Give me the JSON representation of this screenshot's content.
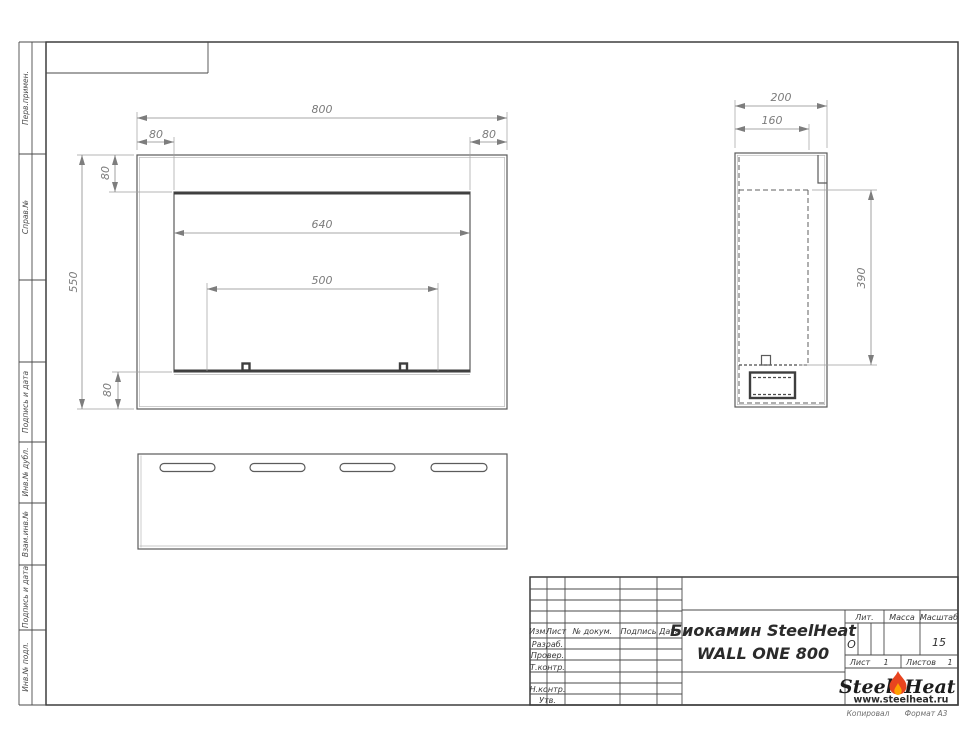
{
  "sheet": {
    "copied_note": "Копировал",
    "format_note": "Формат А3"
  },
  "sidebar": {
    "top_labels": [
      "Перв.примен.",
      "Справ.№"
    ],
    "bottom_labels": [
      "Подпись и дата",
      "Инв.№ дубл.",
      "Взам.инв.№",
      "Подпись и дата",
      "Инв.№ подл."
    ]
  },
  "title_block": {
    "header_cols": [
      "Изм.",
      "Лист",
      "№ докум.",
      "Подпись",
      "Дата"
    ],
    "row_labels": [
      "Разраб.",
      "Провер.",
      "Т.контр.",
      "Н.контр.",
      "Утв."
    ],
    "doc_title_line1": "Биокамин SteelHeat",
    "doc_title_line2": "WALL ONE 800",
    "lit_label": "Лит.",
    "lit_value": "О",
    "massa_label": "Масса",
    "masshtab_label": "Масштаб",
    "masshtab_value": "15",
    "list_label": "Лист",
    "list_value": "1",
    "listov_label": "Листов",
    "listov_value": "1",
    "logo_text1": "Steel",
    "logo_text2": "Heat",
    "logo_url": "www.steelheat.ru"
  },
  "views": {
    "front": {
      "dim_overall_width": "800",
      "dim_flange_left": "80",
      "dim_flange_right": "80",
      "dim_flange_top": "80",
      "dim_overall_height": "550",
      "dim_flange_bottom": "80",
      "dim_opening_width": "640",
      "dim_burner_width": "500"
    },
    "side": {
      "dim_depth": "200",
      "dim_inner_depth": "160",
      "dim_opening_height": "390"
    }
  },
  "colors": {
    "flame_outer": "#e8441f",
    "flame_inner": "#ffa000",
    "line_main": "#4a4a4a"
  }
}
